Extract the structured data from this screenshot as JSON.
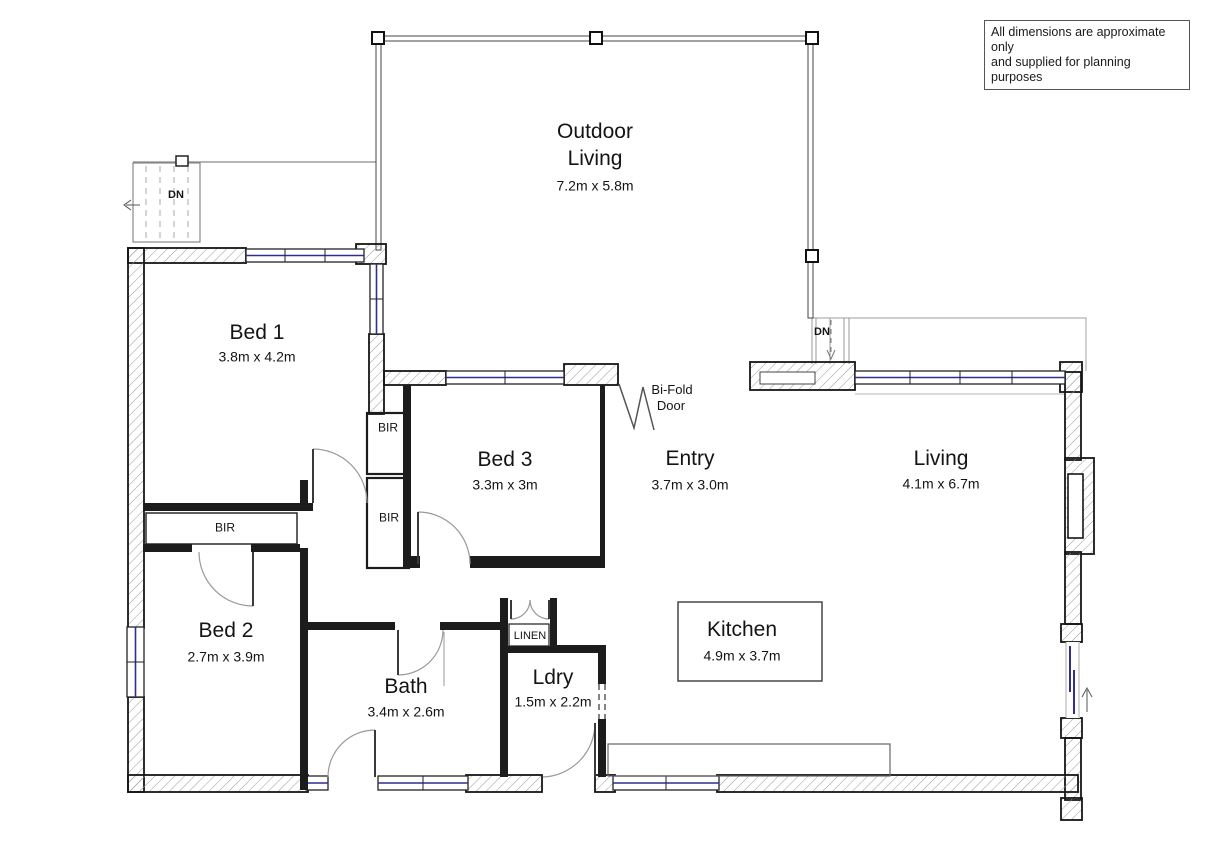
{
  "disclaimer": {
    "line1": "All dimensions are approximate only",
    "line2": "and supplied for planning purposes"
  },
  "rooms": {
    "outdoor_living": {
      "name_line1": "Outdoor",
      "name_line2": "Living",
      "dims": "7.2m x 5.8m"
    },
    "bed1": {
      "name": "Bed 1",
      "dims": "3.8m x 4.2m"
    },
    "bed3": {
      "name": "Bed 3",
      "dims": "3.3m x 3m"
    },
    "entry": {
      "name": "Entry",
      "dims": "3.7m x 3.0m"
    },
    "living": {
      "name": "Living",
      "dims": "4.1m x 6.7m"
    },
    "bed2": {
      "name": "Bed 2",
      "dims": "2.7m x 3.9m"
    },
    "bath": {
      "name": "Bath",
      "dims": "3.4m x 2.6m"
    },
    "ldry": {
      "name": "Ldry",
      "dims": "1.5m x 2.2m"
    },
    "kitchen": {
      "name": "Kitchen",
      "dims": "4.9m x 3.7m"
    }
  },
  "labels": {
    "bir": "BIR",
    "linen": "LINEN",
    "dn": "DN",
    "bifold_line1": "Bi-Fold",
    "bifold_line2": "Door"
  },
  "colors": {
    "wall": "#1c1c1c",
    "glazing": "#2f2f8f",
    "door_arc": "#9a9a9a",
    "hatch": "#9a9a9a",
    "background": "#ffffff"
  }
}
